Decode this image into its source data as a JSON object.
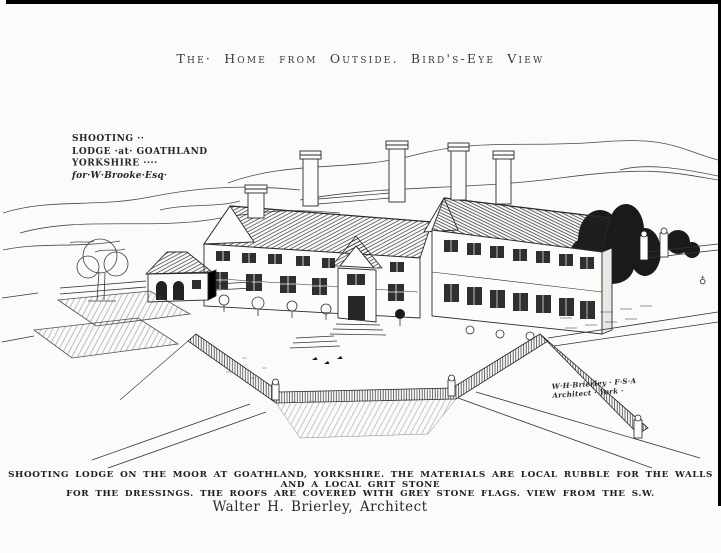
{
  "page": {
    "title": "The· Home from Outside. Bird's-Eye View",
    "margin_mark": "♁"
  },
  "drawing": {
    "inscription": {
      "line1": "SHOOTING ··",
      "line2": "LODGE ·at· GOATHLAND",
      "line3": "YORKSHIRE ····",
      "line4": "for·W·Brooke·Esq·"
    },
    "signature": {
      "line1": "W·H·Brierley · F·S·A",
      "line2": "Architect ·  York ·"
    }
  },
  "caption": {
    "line1": "SHOOTING LODGE ON THE MOOR AT GOATHLAND, YORKSHIRE. THE MATERIALS ARE LOCAL RUBBLE FOR THE WALLS AND A LOCAL GRIT STONE",
    "line2": "FOR THE DRESSINGS. THE ROOFS ARE COVERED WITH GREY STONE FLAGS. VIEW FROM THE S.W.",
    "architect_credit": "Walter H. Brierley, Architect"
  },
  "colors": {
    "paper": "#fbfbf9",
    "ink": "#222222",
    "border": "#000000"
  }
}
